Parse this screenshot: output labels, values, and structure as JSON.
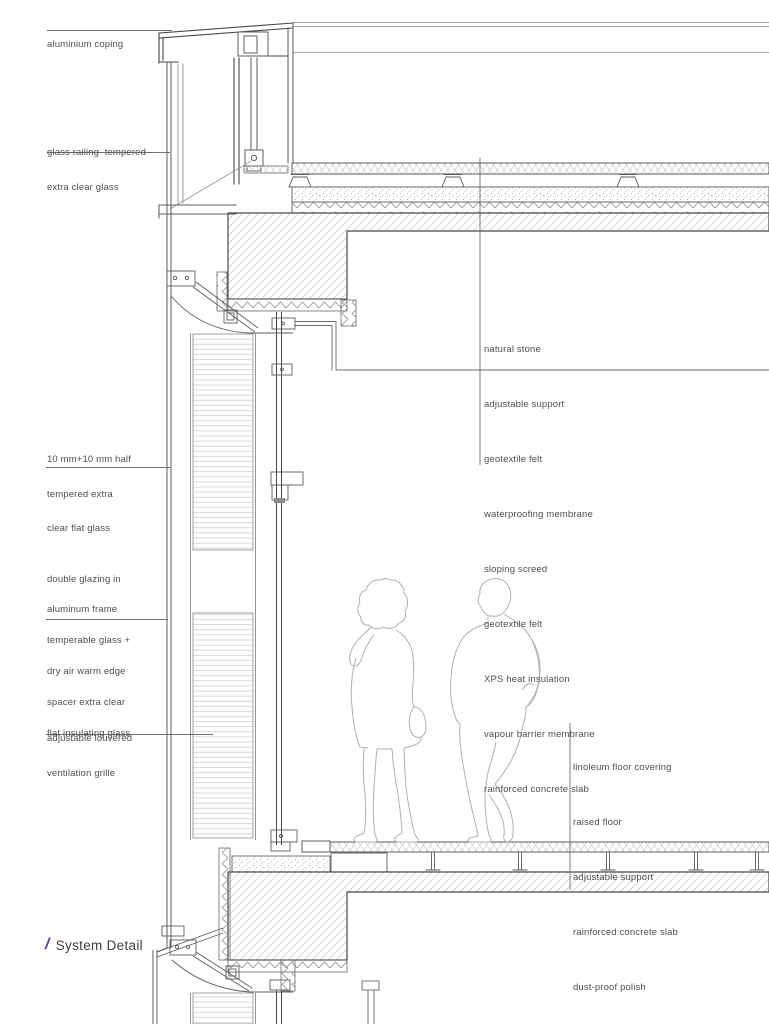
{
  "title": {
    "slash": "/",
    "text": "System Detail"
  },
  "annotations": {
    "left": [
      {
        "id": "aluminium-coping",
        "lines": [
          "aluminium coping"
        ]
      },
      {
        "id": "glass-railing",
        "lines": [
          "glass railing  tempered",
          "extra clear glass"
        ]
      },
      {
        "id": "half-tempered-glass",
        "lines": [
          "10 mm+10 mm half",
          "tempered extra",
          "clear flat glass"
        ]
      },
      {
        "id": "double-glazing",
        "lines": [
          "double glazing in",
          "aluminum frame",
          "temperable glass +",
          "dry air warm edge",
          "spacer extra clear",
          "flat insulating glass"
        ]
      },
      {
        "id": "ventilation-grille",
        "lines": [
          "adjustable louvered",
          "ventilation grille"
        ]
      }
    ],
    "roof_layers": [
      "natural stone",
      "adjustable support",
      "geotextile felt",
      "waterproofing membrane",
      "sloping screed",
      "geotextile felt",
      "XPS heat insulation",
      "vapour barrier membrane",
      "rainforced concrete slab"
    ],
    "floor_layers": [
      "linoleum floor covering",
      "raised floor",
      "adjustable support",
      "rainforced concrete slab",
      "dust-proof polish"
    ]
  },
  "colors": {
    "accent_blue": "#3b4aa0",
    "line_dark": "#4a4a4a",
    "line_mid": "#5c5c5c",
    "hatch_gray": "#c2c2c2",
    "text_gray": "#4f4f4f",
    "figure_gray": "#b0b0b0"
  }
}
